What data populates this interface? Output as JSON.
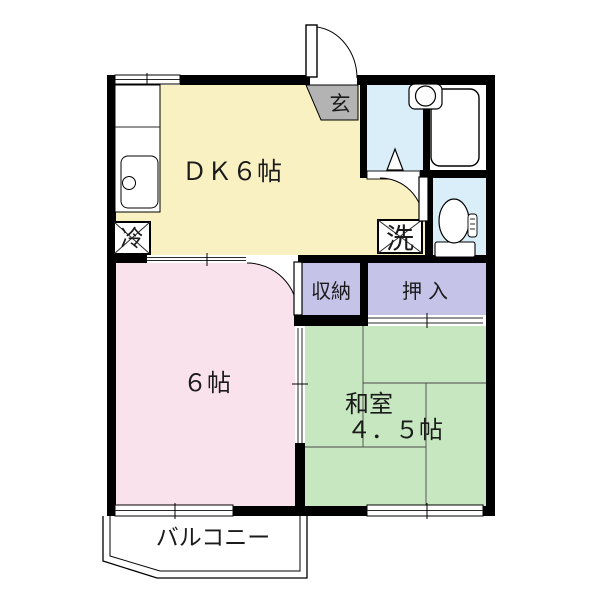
{
  "floor_plan": {
    "wall_color": "#000000",
    "rooms": {
      "dk": {
        "label": "ＤＫ６帖",
        "color": "#F9F1C1"
      },
      "western_room": {
        "label": "６帖",
        "color": "#FAE2EC"
      },
      "japanese_room": {
        "label_line1": "和室",
        "label_line2": "４．５帖",
        "color": "#C6E7BF"
      },
      "storage": {
        "label": "収納",
        "color": "#C5C3E8"
      },
      "closet": {
        "label": "押入",
        "color": "#C5C3E8"
      },
      "entrance": {
        "label": "玄",
        "color": "#B3B3B3"
      },
      "washroom": {
        "color": "#D9EEF8"
      },
      "toilet_room": {
        "color": "#D9EEF8"
      },
      "balcony": {
        "label": "バルコニー",
        "color": "#FFFFFF"
      }
    },
    "fixtures": {
      "refrigerator": {
        "label": "冷"
      },
      "laundry": {
        "label": "洗"
      }
    }
  }
}
